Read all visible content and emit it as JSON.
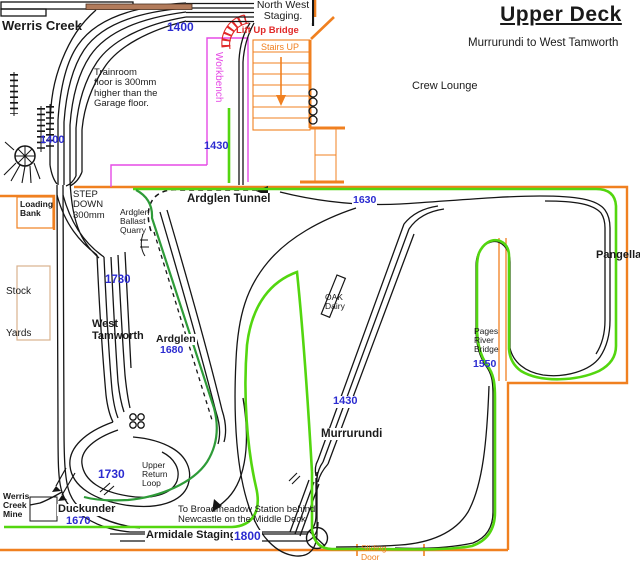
{
  "header": {
    "title": "Upper Deck",
    "subtitle": "Murrurundi to West Tamworth"
  },
  "rooms": {
    "crew_lounge": "Crew Lounge",
    "stairs": "Stairs UP",
    "sliding_door": "Sliding\nDoor",
    "workbench": "Workbench",
    "loading_bank": "Loading\nBank",
    "stock_yards": "Stock\n\nYards",
    "trainroom_note": "Trainroom\nfloor is 300mm\nhigher than the\nGarage floor.",
    "step_down": "STEP\nDOWN\n300mm",
    "lift_up_bridge": "Lift Up Bridge"
  },
  "stations": {
    "werris_creek": "Werris Creek",
    "north_west_staging": "North West\nStaging.",
    "ardglen_tunnel": "Ardglen Tunnel",
    "ardglen_quarry": "Ardglen\nBallast\nQuarry",
    "ardglen": "Ardglen",
    "west_tamworth": "West\nTamworth",
    "pangella": "Pangella",
    "oak_dairy": "OAK\nDairy",
    "pages_river_bridge": "Pages\nRiver\nBridge",
    "murrurundi": "Murrurundi",
    "upper_return_loop": "Upper\nReturn\nLoop",
    "duckunder": "Duckunder",
    "werris_creek_mine": "Werris\nCreek\nMine",
    "armidale_staging": "Armidale Staging",
    "broadmeadow_note": "To Broadmeadow Station behind\nNewcastle on the Middle Deck"
  },
  "elevations": {
    "nw_staging": "1400",
    "werris_creek": "1400",
    "workbench_line": "1430",
    "tunnel_line": "1630",
    "west_tamworth": "1730",
    "ardglen": "1680",
    "pages_river": "1550",
    "murrurundi": "1430",
    "return_loop": "1730",
    "duckunder": "1670",
    "armidale": "1800"
  },
  "colors": {
    "wall_orange": "#f08020",
    "route_green": "#53d60f",
    "branch_green": "#2e9b38",
    "elevation_blue": "#2b2bd0",
    "bridge_red": "#e12828",
    "workbench_magenta": "#e54ae5",
    "track_black": "#151515",
    "platform_brown": "#b27b5b",
    "stockyard_tan": "#d8b28e"
  }
}
